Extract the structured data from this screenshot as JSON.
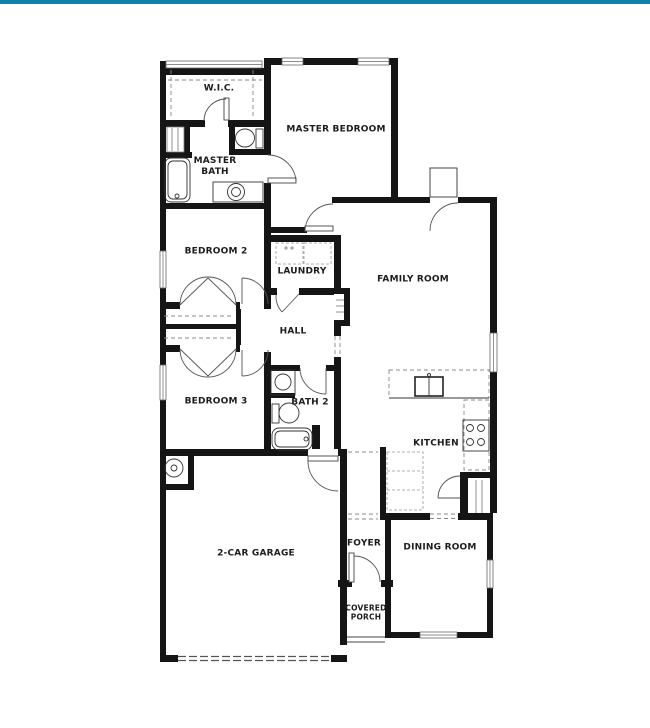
{
  "colors": {
    "accent_bar": "#1181a9",
    "wall": "#151515",
    "line": "#333333"
  },
  "floor_plan": {
    "rooms": [
      {
        "id": "wic",
        "label": "W.I.C."
      },
      {
        "id": "master-bath",
        "label": "MASTER\nBATH"
      },
      {
        "id": "master-bedroom",
        "label": "MASTER BEDROOM"
      },
      {
        "id": "bedroom-2",
        "label": "BEDROOM 2"
      },
      {
        "id": "laundry",
        "label": "LAUNDRY"
      },
      {
        "id": "family-room",
        "label": "FAMILY ROOM"
      },
      {
        "id": "hall",
        "label": "HALL"
      },
      {
        "id": "bedroom-3",
        "label": "BEDROOM 3"
      },
      {
        "id": "bath-2",
        "label": "BATH 2"
      },
      {
        "id": "kitchen",
        "label": "KITCHEN"
      },
      {
        "id": "garage",
        "label": "2-CAR GARAGE"
      },
      {
        "id": "foyer",
        "label": "FOYER"
      },
      {
        "id": "dining-room",
        "label": "DINING ROOM"
      },
      {
        "id": "covered-porch",
        "label": "COVERED\nPORCH"
      }
    ],
    "fixtures": [
      "master-bath-tub",
      "master-bath-toilet",
      "master-bath-sink",
      "master-bath-linen-shelves",
      "wic-closet-shelves",
      "washer",
      "dryer",
      "hall-linen-shelves",
      "bedroom-closet-rods",
      "bath2-sink",
      "bath2-toilet",
      "bath2-tub",
      "kitchen-sink",
      "stove-cooktop",
      "kitchen-counter",
      "pantry-shelves",
      "storage-closet-shelves",
      "water-heater",
      "garage-door",
      "front-door",
      "exterior-door",
      "window"
    ]
  }
}
